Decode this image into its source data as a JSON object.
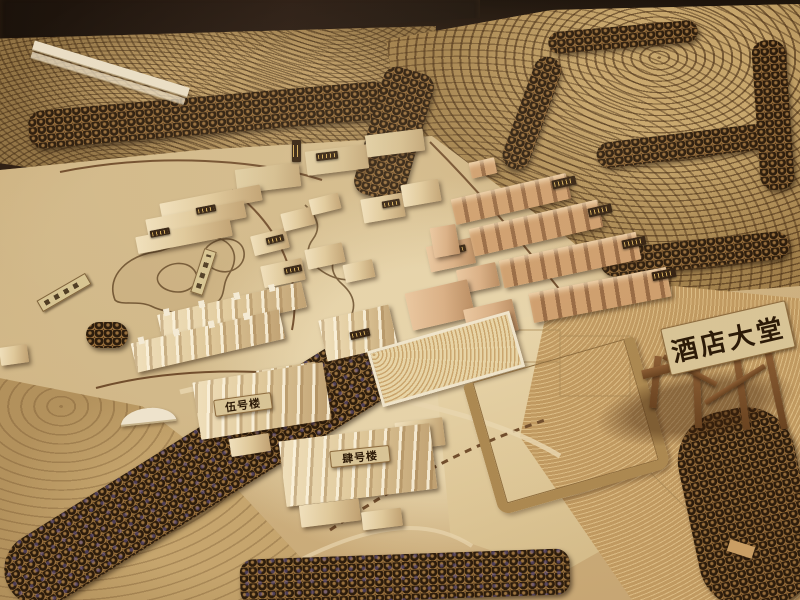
{
  "scene": {
    "kind": "photograph of a wooden architectural site model of a hotel resort",
    "signs": {
      "hotel_lobby": "酒店大堂",
      "building_five": "伍号楼",
      "building_four": "肆号楼"
    },
    "palette": {
      "backdrop": "#1c120c",
      "hill_base": "#9c7c4c",
      "contour_line": "#4c3118",
      "site_light_wood": "#e6d4ac",
      "site_tan": "#c9ab79",
      "tree_dark": "#30210f",
      "plaque_dark": "#2b1b0d",
      "sign_cream": "#dac79b",
      "sign_text": "#241505"
    }
  }
}
